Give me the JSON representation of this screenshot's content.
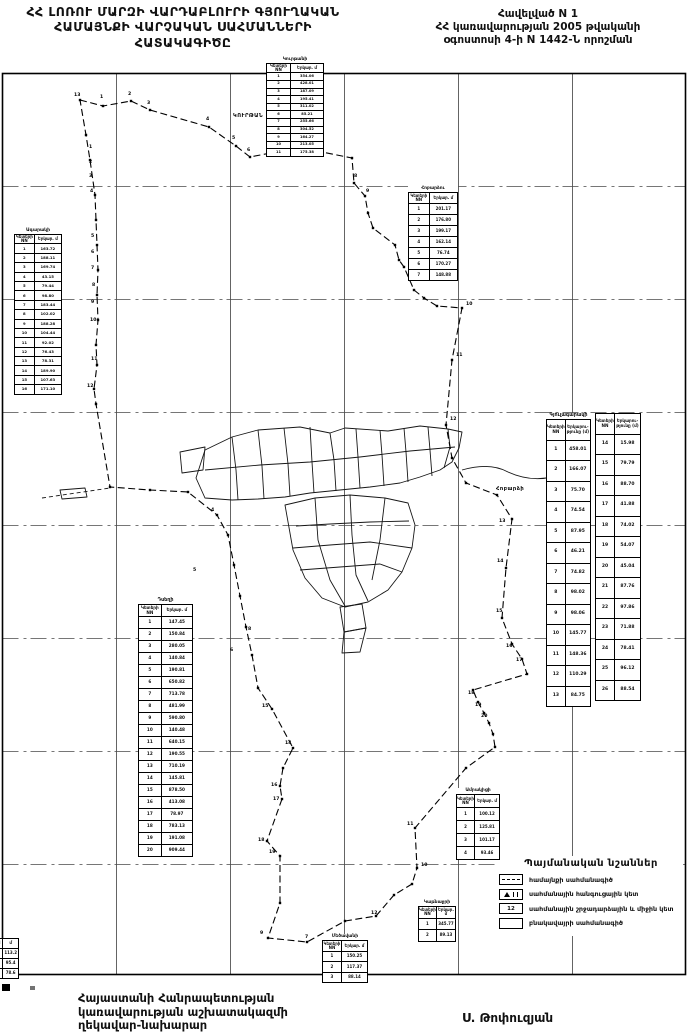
{
  "header": {
    "title_line1": "ՀՀ ԼՈՌՈՒ ՄԱՐԶԻ ՎԱՐԴԱԲԼՈՒՐԻ ԳՅՈՒՂԱԿԱՆ",
    "title_line2": "ՀԱՄԱՅՆՔԻ ՎԱՐՉԱԿԱՆ  ՍԱՀՄԱՆՆԵՐԻ",
    "title_line3": "ՀԱՏԱԿԱԳԻԾԸ",
    "appendix_line1": "Հավելված N 1",
    "appendix_line2": "ՀՀ կառավարության 2005 թվականի",
    "appendix_line3": "օգոստոսի 4-ի N 1442-Ն որոշման"
  },
  "footer": {
    "left_line1": "Հայաստանի Հանրապետության",
    "left_line2": "կառավարության աշխատակազմի",
    "left_line3": "ղեկավար-նախարար",
    "signature": "Ս. Թոփուզյան"
  },
  "legend": {
    "title": "Պայմանական նշաններ",
    "items": [
      {
        "icon": "boundary-line-sample",
        "icon_text": "",
        "label": "համայնքի սահմանագիծ"
      },
      {
        "icon": "node-point-sample",
        "icon_text": "",
        "label": "սահմանային հանգուցային կետ"
      },
      {
        "icon": "turn-point-sample",
        "icon_text": "12",
        "label": "սահմանային շրջադարձային և միջին կետ"
      },
      {
        "icon": "settlement-line-sample",
        "icon_text": "",
        "label": "բնակավայրի սահմանագիծ"
      }
    ]
  },
  "map": {
    "neighbor_labels": [
      {
        "text": "ԿՈՒՐԹԱՆ",
        "x": 233,
        "y": 117
      },
      {
        "text": "Հոբարձի",
        "x": 496,
        "y": 490
      }
    ],
    "points": [
      {
        "t": "13",
        "x": 74,
        "y": 96
      },
      {
        "t": "1",
        "x": 100,
        "y": 98
      },
      {
        "t": "2",
        "x": 128,
        "y": 95
      },
      {
        "t": "3",
        "x": 147,
        "y": 104
      },
      {
        "t": "4",
        "x": 206,
        "y": 120
      },
      {
        "t": "5",
        "x": 232,
        "y": 139
      },
      {
        "t": "6",
        "x": 247,
        "y": 151
      },
      {
        "t": "7",
        "x": 303,
        "y": 143
      },
      {
        "t": "8",
        "x": 354,
        "y": 177
      },
      {
        "t": "9",
        "x": 366,
        "y": 192
      },
      {
        "t": "10",
        "x": 466,
        "y": 305
      },
      {
        "t": "11",
        "x": 456,
        "y": 356
      },
      {
        "t": "12",
        "x": 450,
        "y": 420
      },
      {
        "t": "1",
        "x": 89,
        "y": 148
      },
      {
        "t": "2",
        "x": 89,
        "y": 163
      },
      {
        "t": "3",
        "x": 89,
        "y": 177
      },
      {
        "t": "4",
        "x": 90,
        "y": 192
      },
      {
        "t": "5",
        "x": 91,
        "y": 237
      },
      {
        "t": "6",
        "x": 91,
        "y": 253
      },
      {
        "t": "7",
        "x": 91,
        "y": 269
      },
      {
        "t": "8",
        "x": 92,
        "y": 286
      },
      {
        "t": "9",
        "x": 91,
        "y": 303
      },
      {
        "t": "10",
        "x": 90,
        "y": 321
      },
      {
        "t": "11",
        "x": 91,
        "y": 360
      },
      {
        "t": "12",
        "x": 87,
        "y": 387
      },
      {
        "t": "13",
        "x": 499,
        "y": 522
      },
      {
        "t": "14",
        "x": 497,
        "y": 562
      },
      {
        "t": "15",
        "x": 496,
        "y": 612
      },
      {
        "t": "16",
        "x": 506,
        "y": 647
      },
      {
        "t": "17",
        "x": 516,
        "y": 661
      },
      {
        "t": "18",
        "x": 468,
        "y": 694
      },
      {
        "t": "19",
        "x": 475,
        "y": 706
      },
      {
        "t": "20",
        "x": 481,
        "y": 717
      },
      {
        "t": "15",
        "x": 262,
        "y": 707
      },
      {
        "t": "14",
        "x": 285,
        "y": 744
      },
      {
        "t": "16",
        "x": 271,
        "y": 786
      },
      {
        "t": "17",
        "x": 273,
        "y": 800
      },
      {
        "t": "18",
        "x": 258,
        "y": 841
      },
      {
        "t": "19",
        "x": 269,
        "y": 853
      },
      {
        "t": "12",
        "x": 371,
        "y": 914
      },
      {
        "t": "9",
        "x": 260,
        "y": 934
      },
      {
        "t": "10",
        "x": 421,
        "y": 866
      },
      {
        "t": "11",
        "x": 407,
        "y": 825
      },
      {
        "t": "4",
        "x": 211,
        "y": 511
      },
      {
        "t": "5",
        "x": 193,
        "y": 571
      },
      {
        "t": "6",
        "x": 230,
        "y": 651
      },
      {
        "t": "8",
        "x": 248,
        "y": 630
      },
      {
        "t": "7",
        "x": 305,
        "y": 938
      }
    ]
  },
  "tables": [
    {
      "id": "t1",
      "title": "Կուրթանի",
      "headers": [
        "Կետերի NN",
        "Երկար. մ"
      ],
      "rows": [
        [
          "1",
          "354.06"
        ],
        [
          "2",
          "428.01"
        ],
        [
          "3",
          "187.09"
        ],
        [
          "4",
          "195.41"
        ],
        [
          "5",
          "311.02"
        ],
        [
          "6",
          "85.21"
        ],
        [
          "7",
          "255.66"
        ],
        [
          "8",
          "304.52"
        ],
        [
          "9",
          "164.27"
        ],
        [
          "10",
          "213.05"
        ],
        [
          "11",
          "175.38"
        ]
      ]
    },
    {
      "id": "t2",
      "title": "Հոբարձու",
      "headers": [
        "Կետերի NN",
        "Երկար. մ"
      ],
      "rows": [
        [
          "1",
          "201.17"
        ],
        [
          "2",
          "176.80"
        ],
        [
          "3",
          "199.17"
        ],
        [
          "4",
          "162.14"
        ],
        [
          "5",
          "76.74"
        ],
        [
          "6",
          "170.27"
        ],
        [
          "7",
          "148.88"
        ]
      ]
    },
    {
      "id": "t3",
      "title": "Ագարակի",
      "headers": [
        "Կետերի NN",
        "Երկար. մ"
      ],
      "rows": [
        [
          "1",
          "163.72"
        ],
        [
          "2",
          "188.11"
        ],
        [
          "3",
          "169.74"
        ],
        [
          "4",
          "43.15"
        ],
        [
          "5",
          "79.44"
        ],
        [
          "6",
          "98.80"
        ],
        [
          "7",
          "183.44"
        ],
        [
          "8",
          "102.02"
        ],
        [
          "9",
          "188.28"
        ],
        [
          "10",
          "104.44"
        ],
        [
          "11",
          "92.02"
        ],
        [
          "12",
          "76.43"
        ],
        [
          "13",
          "78.31"
        ],
        [
          "14",
          "189.90"
        ],
        [
          "15",
          "107.63"
        ],
        [
          "16",
          "171.10"
        ]
      ]
    },
    {
      "id": "t4",
      "title": "Դսեղի",
      "headers": [
        "Կետերի NN",
        "Երկար. մ"
      ],
      "rows": [
        [
          "1",
          "147.45"
        ],
        [
          "2",
          "150.84"
        ],
        [
          "3",
          "280.05"
        ],
        [
          "4",
          "140.84"
        ],
        [
          "5",
          "190.81"
        ],
        [
          "6",
          "650.82"
        ],
        [
          "7",
          "713.78"
        ],
        [
          "8",
          "481.99"
        ],
        [
          "9",
          "590.80"
        ],
        [
          "10",
          "140.48"
        ],
        [
          "11",
          "640.15"
        ],
        [
          "12",
          "190.55"
        ],
        [
          "13",
          "710.19"
        ],
        [
          "14",
          "145.81"
        ],
        [
          "15",
          "878.50"
        ],
        [
          "16",
          "413.08"
        ],
        [
          "17",
          "78.97"
        ],
        [
          "18",
          "783.13"
        ],
        [
          "19",
          "191.08"
        ],
        [
          "20",
          "909.44"
        ]
      ]
    },
    {
      "id": "t5a",
      "title": "Գյուլագարակի",
      "headers": [
        "Կետերի NN",
        "Երկարու- թյունը (մ)"
      ],
      "rows": [
        [
          "1",
          "458.01"
        ],
        [
          "2",
          "166.07"
        ],
        [
          "3",
          "75.70"
        ],
        [
          "4",
          "74.54"
        ],
        [
          "5",
          "87.95"
        ],
        [
          "6",
          "46.21"
        ],
        [
          "7",
          "74.82"
        ],
        [
          "8",
          "98.02"
        ],
        [
          "9",
          "98.06"
        ],
        [
          "10",
          "145.77"
        ],
        [
          "11",
          "148.36"
        ],
        [
          "12",
          "110.29"
        ],
        [
          "13",
          "84.75"
        ]
      ]
    },
    {
      "id": "t5b",
      "title": "",
      "headers": [
        "Կետերի NN",
        "Երկարու- թյունը (մ)"
      ],
      "rows": [
        [
          "14",
          "15.98"
        ],
        [
          "15",
          "79.79"
        ],
        [
          "16",
          "88.70"
        ],
        [
          "17",
          "41.88"
        ],
        [
          "18",
          "74.02"
        ],
        [
          "19",
          "54.07"
        ],
        [
          "20",
          "45.04"
        ],
        [
          "21",
          "87.76"
        ],
        [
          "22",
          "97.86"
        ],
        [
          "23",
          "71.88"
        ],
        [
          "24",
          "78.41"
        ],
        [
          "25",
          "96.12"
        ],
        [
          "26",
          "88.54"
        ]
      ]
    },
    {
      "id": "t6",
      "title": "Ամրակիցի",
      "headers": [
        "Կետերի NN",
        "Երկար. մ"
      ],
      "rows": [
        [
          "1",
          "100.12"
        ],
        [
          "2",
          "125.81"
        ],
        [
          "3",
          "101.17"
        ],
        [
          "4",
          "93.46"
        ]
      ]
    },
    {
      "id": "t7",
      "title": "Կաթնաջրի",
      "headers": [
        "Կետերի NN",
        "Երկար. մ"
      ],
      "rows": [
        [
          "1",
          "345.77"
        ],
        [
          "2",
          "89.13"
        ]
      ]
    },
    {
      "id": "t8",
      "title": "Մեծավանի",
      "headers": [
        "Կետերի NN",
        "Երկար. մ"
      ],
      "rows": [
        [
          "1",
          "150.25"
        ],
        [
          "2",
          "117.37"
        ],
        [
          "3",
          "88.14"
        ]
      ]
    },
    {
      "id": "t9",
      "title": "",
      "headers": [
        "NN",
        "մ"
      ],
      "rows": [
        [
          "1",
          "113.2"
        ],
        [
          "2",
          "95.4"
        ],
        [
          "3",
          "78.6"
        ]
      ]
    }
  ]
}
